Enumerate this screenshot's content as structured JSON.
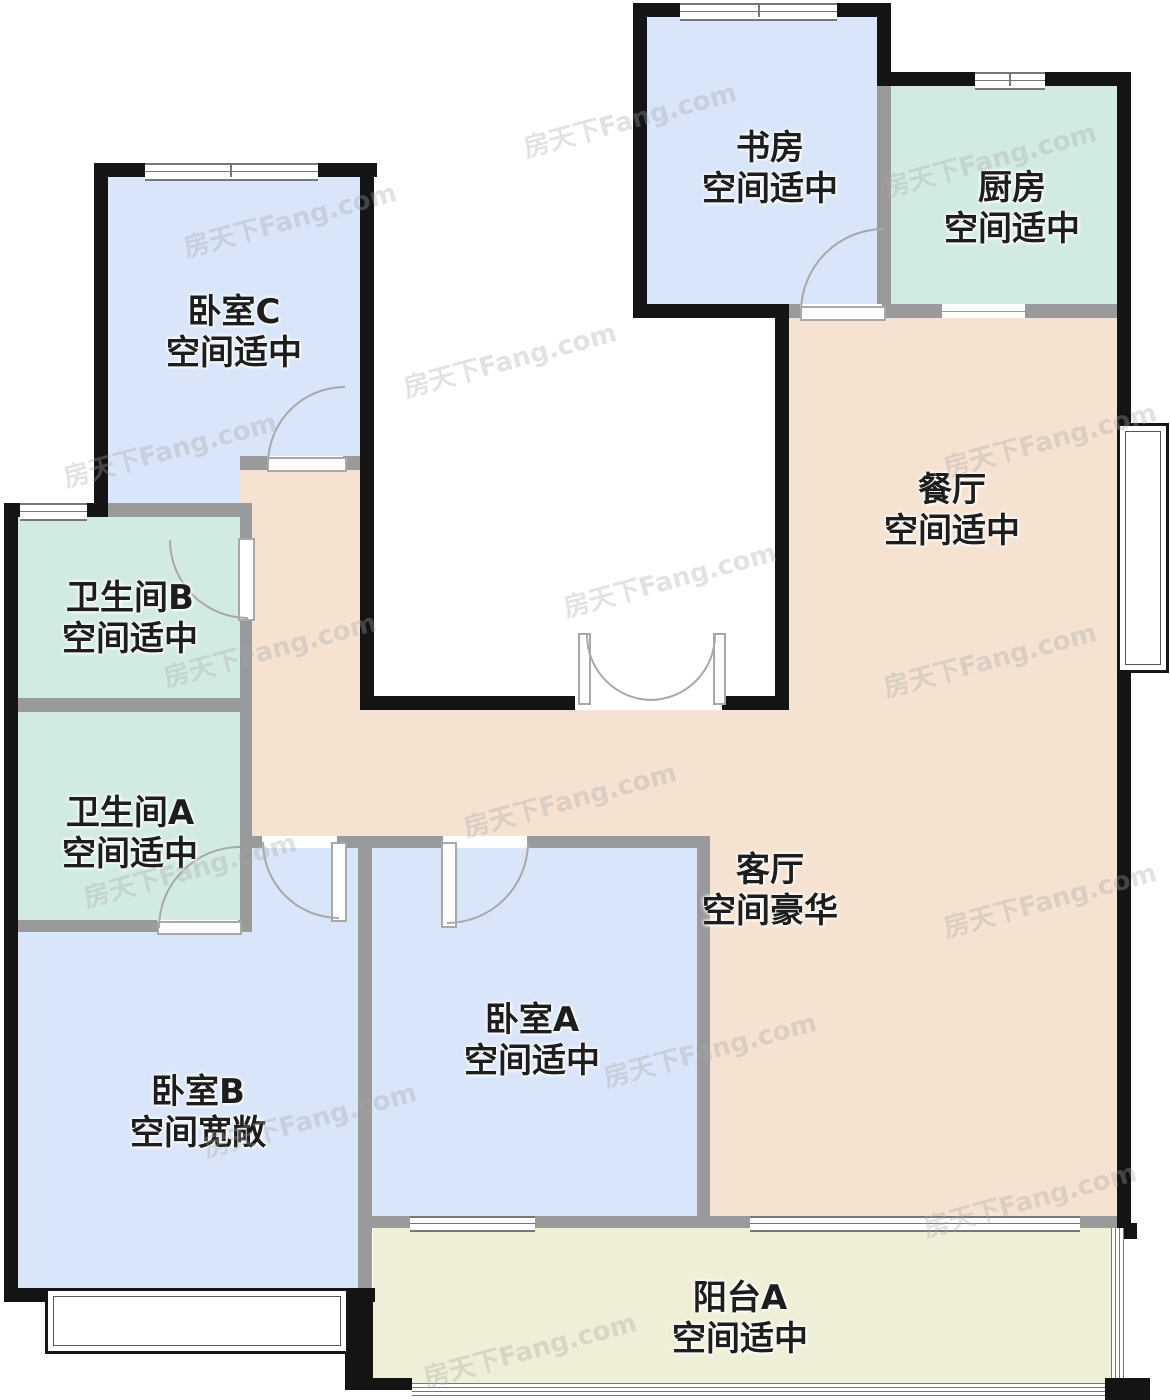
{
  "watermark": {
    "text": "房天下Fang.com"
  },
  "colors": {
    "bedroom_fill": "#d9e5f9",
    "bath_kitchen_fill": "#d2ebe2",
    "living_dining_fill": "#f5e2d1",
    "balcony_fill": "#efefd8",
    "exterior_wall": "#141414",
    "interior_wall": "#9a9a9a"
  },
  "rooms": {
    "bedroom_c": {
      "name": "卧室C",
      "condition": "空间适中"
    },
    "study": {
      "name": "书房",
      "condition": "空间适中"
    },
    "kitchen": {
      "name": "厨房",
      "condition": "空间适中"
    },
    "dining": {
      "name": "餐厅",
      "condition": "空间适中"
    },
    "bathroom_b": {
      "name": "卫生间B",
      "condition": "空间适中"
    },
    "bathroom_a": {
      "name": "卫生间A",
      "condition": "空间适中"
    },
    "living": {
      "name": "客厅",
      "condition": "空间豪华"
    },
    "bedroom_a": {
      "name": "卧室A",
      "condition": "空间适中"
    },
    "bedroom_b": {
      "name": "卧室B",
      "condition": "空间宽敞"
    },
    "balcony_a": {
      "name": "阳台A",
      "condition": "空间适中"
    }
  }
}
